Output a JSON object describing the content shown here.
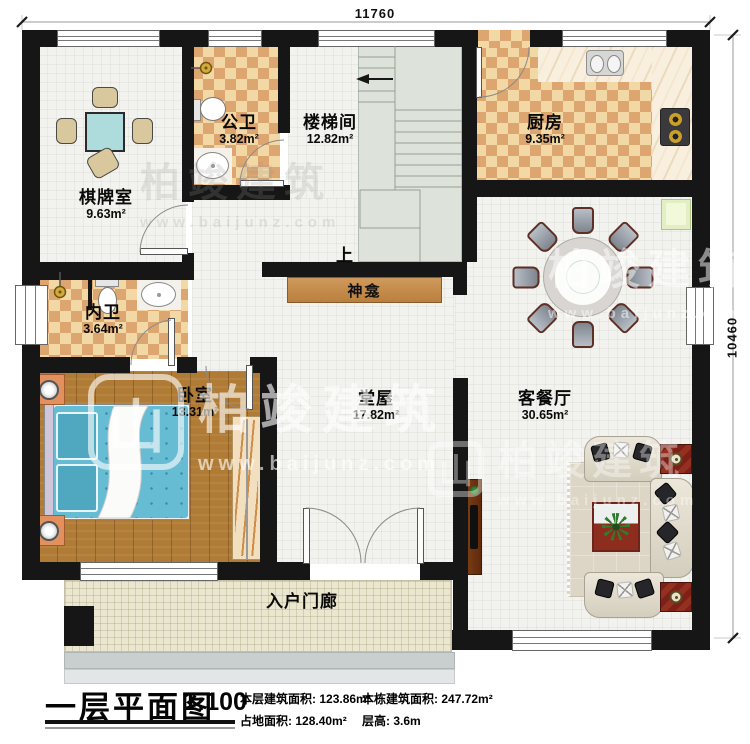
{
  "dimensions": {
    "top_width": "11760",
    "right_height": "10460"
  },
  "rooms": {
    "qipai": {
      "name": "棋牌室",
      "area": "9.63m²"
    },
    "gongwei": {
      "name": "公卫",
      "area": "3.82m²"
    },
    "loutijian": {
      "name": "楼梯间",
      "area": "12.82m²"
    },
    "chufang": {
      "name": "厨房",
      "area": "9.35m²"
    },
    "neiwei": {
      "name": "内卫",
      "area": "3.64m²"
    },
    "woshi": {
      "name": "卧室",
      "area": "13.31m²"
    },
    "tangwu": {
      "name": "堂屋",
      "area": "17.82m²"
    },
    "kecanting": {
      "name": "客餐厅",
      "area": "30.65m²"
    },
    "porch": {
      "name": "入户门廊"
    },
    "shrine": {
      "name": "神龛"
    }
  },
  "stair": {
    "up_label": "上"
  },
  "title_block": {
    "title": "一层平面图",
    "scale": "1:100",
    "stats": {
      "floor_area_label": "本层建筑面积:",
      "floor_area_value": "123.86m²",
      "land_area_label": "占地面积:",
      "land_area_value": "128.40m²",
      "building_area_label": "本栋建筑面积:",
      "building_area_value": "247.72m²",
      "storey_height_label": "层高:",
      "storey_height_value": "3.6m"
    }
  },
  "watermark": {
    "brand": "柏竣建筑",
    "site": "www.baijunz.com",
    "logo_glyph": "山"
  },
  "colors": {
    "wall": "#161616",
    "checker_light": "#f2d8a4",
    "checker_dark": "#dda56f",
    "wood_floor": "#b07b34",
    "stair_floor": "#dde3da",
    "porch_floor": "#eae6cf",
    "bed": "#66bcd2",
    "shrine": "#c8914f",
    "sofa": "#e0dbcc",
    "end_table": "#7c2018"
  }
}
